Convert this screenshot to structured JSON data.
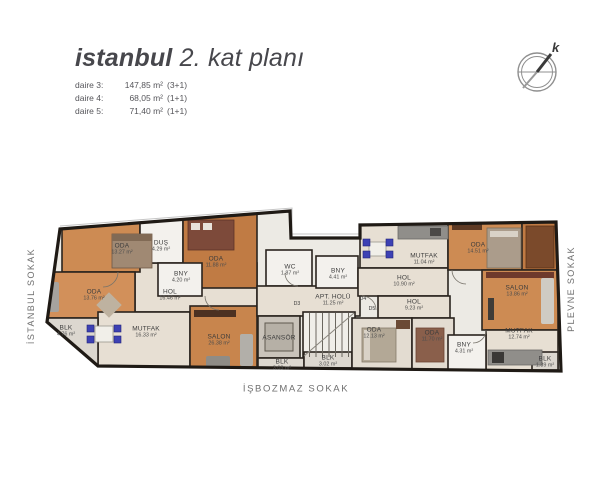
{
  "header": {
    "title": {
      "brand": "istanbul",
      "rest": " 2. kat planı"
    },
    "apartments": [
      {
        "label": "daire 3:",
        "area": "147,85 m²",
        "type": "(3+1)"
      },
      {
        "label": "daire 4:",
        "area": "68,05 m²",
        "type": "(1+1)"
      },
      {
        "label": "daire 5:",
        "area": "71,40 m²",
        "type": "(1+1)"
      }
    ]
  },
  "compass": {
    "north_label": "k"
  },
  "streets": {
    "left": "İSTANBUL SOKAK",
    "right": "PLEVNE SOKAK",
    "bottom": "İŞBOZMAZ SOKAK"
  },
  "plan": {
    "rooms": [
      {
        "name": "ODA",
        "area": "13.27 m²",
        "x": 122,
        "y": 249
      },
      {
        "name": "DUŞ",
        "area": "4.29 m²",
        "x": 161,
        "y": 246
      },
      {
        "name": "ODA",
        "area": "11.88 m²",
        "x": 216,
        "y": 262
      },
      {
        "name": "BNY",
        "area": "4.20 m²",
        "x": 181,
        "y": 277
      },
      {
        "name": "ODA",
        "area": "13.76 m²",
        "x": 94,
        "y": 295
      },
      {
        "name": "HOL",
        "area": "16.46 m²",
        "x": 170,
        "y": 295
      },
      {
        "name": "BLK",
        "area": "4.76 m²",
        "x": 66,
        "y": 331
      },
      {
        "name": "MUTFAK",
        "area": "16.33 m²",
        "x": 146,
        "y": 332
      },
      {
        "name": "SALON",
        "area": "26.38 m²",
        "x": 219,
        "y": 340
      },
      {
        "name": "WC",
        "area": "1.87 m²",
        "x": 290,
        "y": 270
      },
      {
        "name": "BNY",
        "area": "4.41 m²",
        "x": 338,
        "y": 274
      },
      {
        "name": "APT. HOLÜ",
        "area": "11.25 m²",
        "x": 333,
        "y": 300
      },
      {
        "name": "ASANSÖR",
        "area": "",
        "x": 279,
        "y": 338
      },
      {
        "name": "BLK",
        "area": "3.03 m²",
        "x": 282,
        "y": 365
      },
      {
        "name": "BLK",
        "area": "3.02 m²",
        "x": 328,
        "y": 361
      },
      {
        "name": "MUTFAK",
        "area": "11.04 m²",
        "x": 424,
        "y": 259
      },
      {
        "name": "HOL",
        "area": "10.90 m²",
        "x": 404,
        "y": 281
      },
      {
        "name": "HOL",
        "area": "9.23 m²",
        "x": 414,
        "y": 305
      },
      {
        "name": "ODA",
        "area": "12.13 m²",
        "x": 374,
        "y": 333
      },
      {
        "name": "ODA",
        "area": "11.70 m²",
        "x": 432,
        "y": 336
      },
      {
        "name": "BNY",
        "area": "4.31 m²",
        "x": 464,
        "y": 348
      },
      {
        "name": "MUTFAK",
        "area": "12.74 m²",
        "x": 519,
        "y": 334
      },
      {
        "name": "ODA",
        "area": "14.51 m²",
        "x": 478,
        "y": 248
      },
      {
        "name": "SALON",
        "area": "13.86 m²",
        "x": 517,
        "y": 291
      },
      {
        "name": "BLK",
        "area": "1.39 m²",
        "x": 545,
        "y": 362
      }
    ],
    "door_labels": [
      {
        "label": "D3",
        "x": 297,
        "y": 304
      },
      {
        "label": "D4",
        "x": 363,
        "y": 299
      },
      {
        "label": "D5",
        "x": 372,
        "y": 309
      }
    ]
  },
  "colors": {
    "wall": "#1f1a15",
    "wood": "#cd8b53",
    "wood_dark": "#c07b44",
    "tile": "#e7dfd3",
    "bath": "#f3f1ed",
    "balcony": "#dcd7cf",
    "kitchen_chair_blue": "#3d41b4"
  }
}
